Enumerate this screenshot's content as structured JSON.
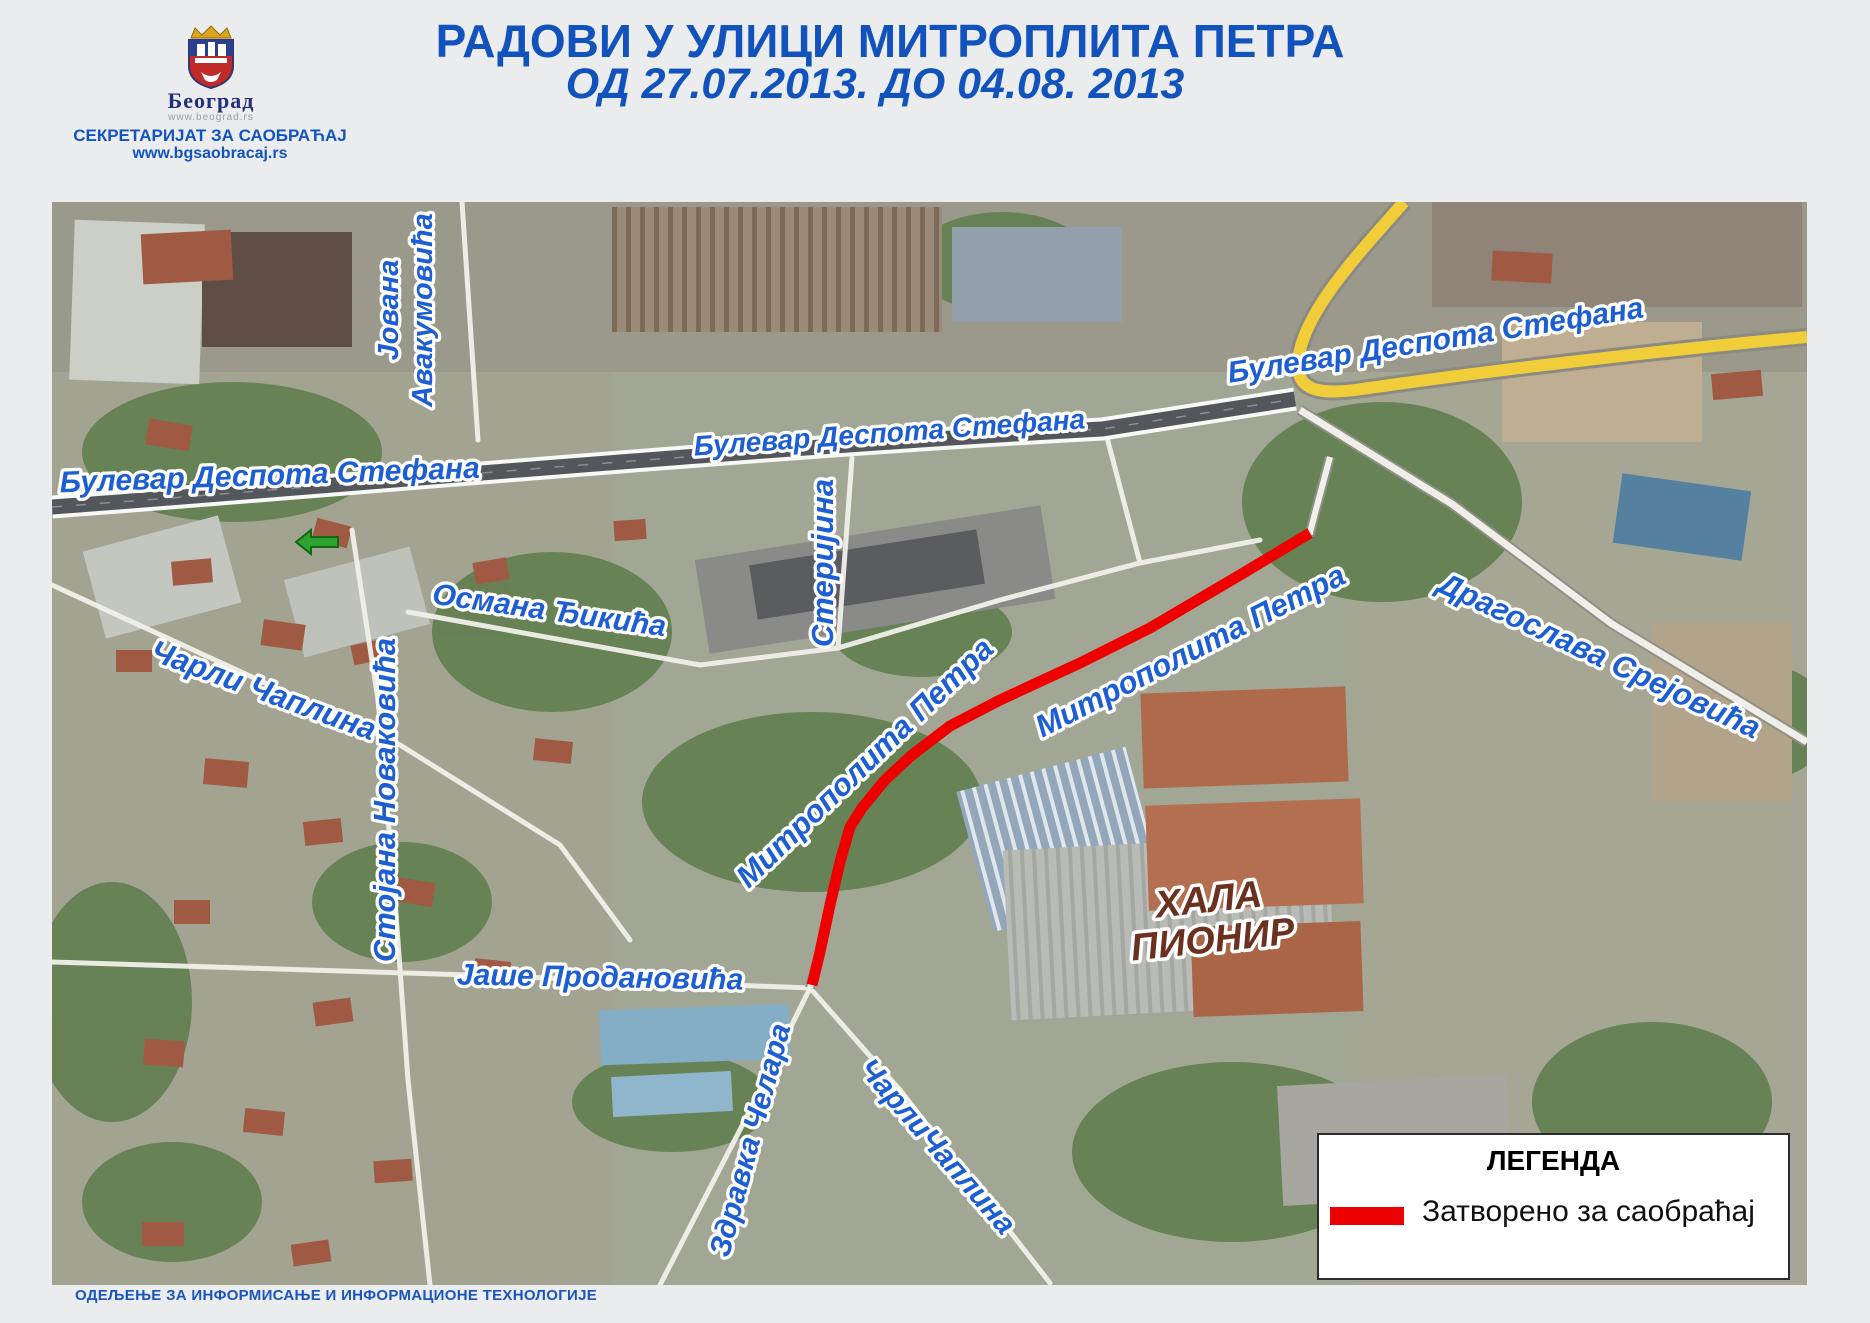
{
  "header": {
    "logo": {
      "city_name": "Београд",
      "city_url": "www.beograd.rs"
    },
    "secretariat": "СЕКРЕТАРИЈАТ ЗА САОБРАЋАЈ",
    "secretariat_url": "www.bgsaobracaj.rs",
    "title_line1": "РАДОВИ У УЛИЦИ МИТРОПЛИТА ПЕТРА",
    "title_line2": "ОД 27.07.2013.  ДО 04.08. 2013",
    "title_color": "#1152bc"
  },
  "map": {
    "label_color": "#1d5ed3",
    "closed_route_color": "#ee0000",
    "highway_color": "#f1cd39",
    "direction_arrow": "green-left-arrow",
    "labels": {
      "bulevar_left": "Булевар Деспота Стефана",
      "bulevar_center": "Булевар Деспота Стефана",
      "bulevar_right": "Булевар Деспота Стефана",
      "jovana_line1": "Јована",
      "jovana_line2": "Авакумовића",
      "osmana": "Османа Ђикића",
      "sterijina": "Стеријина",
      "carli_caplina": "Чарли Чаплина",
      "stojana": "Стојана Новаковића",
      "mitropolita_left": "Митрополита Петра",
      "mitropolita_right": "Митрополита Петра",
      "dragoslava": "Драгослава Срејовића",
      "jase": "Јаше Продановића",
      "zdravka": "Здравка Челара",
      "carlicaplina_bottom": "ЧарлиЧаплина"
    },
    "poi": {
      "hala_line1": "ХАЛА",
      "hala_line2": "ПИОНИР"
    }
  },
  "legend": {
    "title": "ЛЕГЕНДА",
    "items": [
      {
        "symbol_color": "#ee0000",
        "label": "Затворено за саобраћај"
      }
    ]
  },
  "footer": {
    "department": "ОДЕЉЕЊЕ ЗА ИНФОРМИСАЊЕ И ИНФОРМАЦИОНЕ ТЕХНОЛОГИЈЕ"
  }
}
